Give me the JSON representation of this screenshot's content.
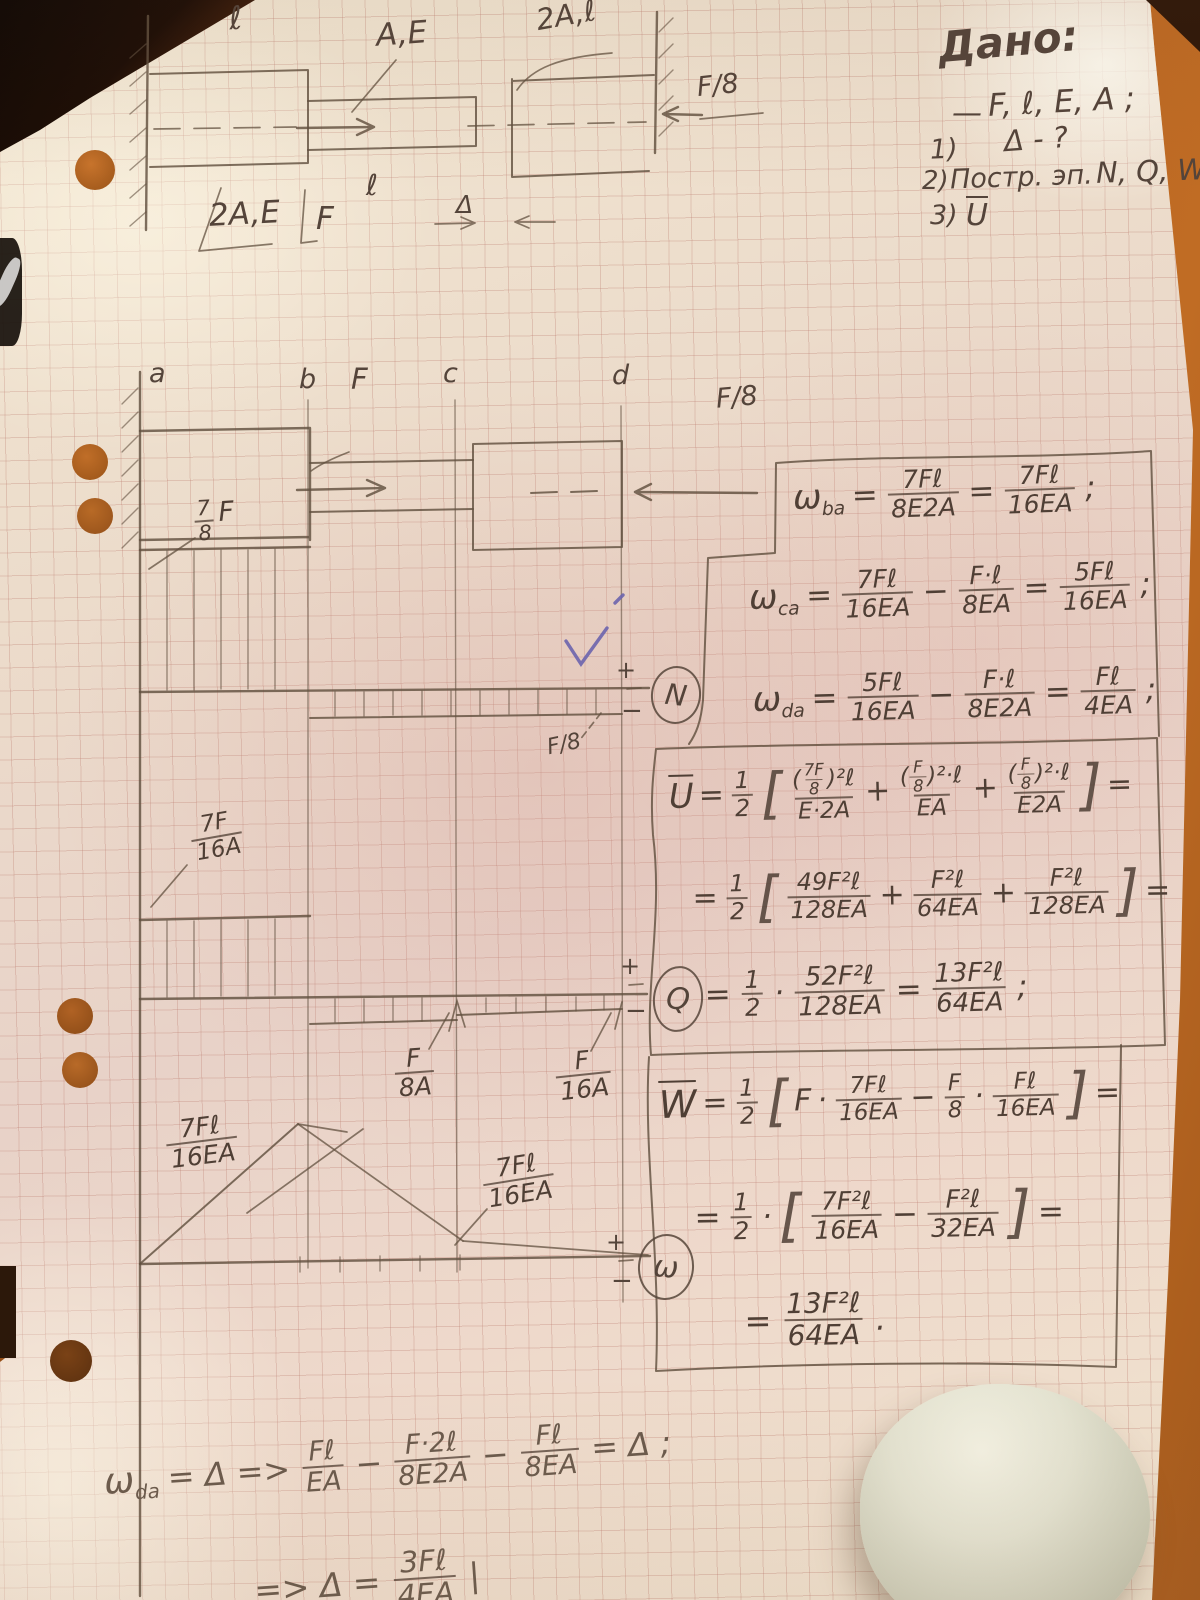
{
  "colors": {
    "pencil": "#5b493d",
    "paper": "#efe2d0",
    "desk": "#b4611f",
    "check_ink": "#6b64ad",
    "grid": "#c98e84"
  },
  "given": {
    "title": "Дано:",
    "dash": "—",
    "vars": "F, ℓ, E, A ;",
    "i1n": "1)",
    "i1": "Δ - ?",
    "i2n": "2)",
    "i2a": "Постр. эп.",
    "i2b": "N, Q, W",
    "i3n": "3)",
    "i3": "U"
  },
  "fig1": {
    "len_top": "ℓ",
    "label_ae": "A,E",
    "label_2al": "2A,ℓ",
    "f8": "F/8",
    "label_2ae": "2A,E",
    "force": "F",
    "len_mid": "ℓ",
    "delta": "Δ"
  },
  "fig2": {
    "a": "a",
    "b": "b",
    "force": "F",
    "c": "c",
    "d": "d",
    "f8": "F/8"
  },
  "ndiag": {
    "num": "7",
    "den": "8",
    "f": "F",
    "neg_label": "F/8",
    "plus": "+",
    "minus": "−",
    "badge": "N"
  },
  "qdiag": {
    "p_num": "7F",
    "p_den": "16A",
    "bc_num": "F",
    "bc_den": "8A",
    "cd_num": "F",
    "cd_den": "16A",
    "plus": "+",
    "minus": "−",
    "badge": "Q"
  },
  "wdiag": {
    "p1_num": "7Fℓ",
    "p1_den": "16EA",
    "p2_num": "7Fℓ",
    "p2_den": "16EA",
    "plus": "+",
    "minus": "−",
    "badge": "ω"
  },
  "fx": {
    "b1": {
      "l1": {
        "sym": "ω",
        "sub": "ba",
        "eq": "=",
        "f1n": "7Fℓ",
        "f1d": "8E2A",
        "eq2": "=",
        "f2n": "7Fℓ",
        "f2d": "16EA",
        "end": ";"
      },
      "l2": {
        "sym": "ω",
        "sub": "ca",
        "eq": "=",
        "f1n": "7Fℓ",
        "f1d": "16EA",
        "op": "−",
        "f2n": "F·ℓ",
        "f2d": "8EA",
        "eq2": "=",
        "f3n": "5Fℓ",
        "f3d": "16EA",
        "end": ";"
      },
      "l3": {
        "sym": "ω",
        "sub": "da",
        "eq": "=",
        "f1n": "5Fℓ",
        "f1d": "16EA",
        "op": "−",
        "f2n": "F·ℓ",
        "f2d": "8E2A",
        "eq2": "=",
        "f3n": "Fℓ",
        "f3d": "4EA",
        "end": ";"
      }
    },
    "b2": {
      "l1": {
        "sym": "U",
        "eq": "=",
        "hn": "1",
        "hd": "2",
        "lb": "[",
        "t1po": "(",
        "t1fn": "7F",
        "t1fd": "8",
        "t1pc": ")²ℓ",
        "t1d": "E·2A",
        "p1": "+",
        "t2po": "(",
        "t2fn": "F",
        "t2fd": "8",
        "t2pc": ")²·ℓ",
        "t2d": "EA",
        "p2": "+",
        "t3po": "(",
        "t3fn": "F",
        "t3fd": "8",
        "t3pc": ")²·ℓ",
        "t3d": "E2A",
        "rb": "]",
        "eq2": "="
      },
      "l2": {
        "eq": "=",
        "hn": "1",
        "hd": "2",
        "lb": "[",
        "f1n": "49F²ℓ",
        "f1d": "128EA",
        "p1": "+",
        "f2n": "F²ℓ",
        "f2d": "64EA",
        "p2": "+",
        "f3n": "F²ℓ",
        "f3d": "128EA",
        "rb": "]",
        "eq2": "="
      },
      "l3": {
        "eq": "=",
        "hn": "1",
        "hd": "2",
        "dot": "·",
        "f1n": "52F²ℓ",
        "f1d": "128EA",
        "eq2": "=",
        "f2n": "13F²ℓ",
        "f2d": "64EA",
        "end": ";"
      }
    },
    "b3": {
      "l1": {
        "sym": "W",
        "eq": "=",
        "hn": "1",
        "hd": "2",
        "lb": "[",
        "f": "F",
        "d1": "·",
        "f1n": "7Fℓ",
        "f1d": "16EA",
        "op": "−",
        "f2n": "F",
        "f2d": "8",
        "d2": "·",
        "f3n": "Fℓ",
        "f3d": "16EA",
        "rb": "]",
        "eq2": "="
      },
      "l2": {
        "eq": "=",
        "hn": "1",
        "hd": "2",
        "dot": "·",
        "lb": "[",
        "f1n": "7F²ℓ",
        "f1d": "16EA",
        "op": "−",
        "f2n": "F²ℓ",
        "f2d": "32EA",
        "rb": "]",
        "eq2": "="
      },
      "l3": {
        "eq": "=",
        "f1n": "13F²ℓ",
        "f1d": "64EA",
        "end": "."
      }
    },
    "bottom": {
      "l1": {
        "sym": "ω",
        "sub": "da",
        "eq": "= Δ  =>",
        "f1n": "Fℓ",
        "f1d": "EA",
        "op1": "−",
        "f2n": "F·2ℓ",
        "f2d": "8E2A",
        "op2": "−",
        "f3n": "Fℓ",
        "f3d": "8EA",
        "eq2": "= Δ ;"
      },
      "l2": {
        "lead": "=> Δ =",
        "f1n": "3Fℓ",
        "f1d": "4EA",
        "end": "|"
      }
    }
  }
}
